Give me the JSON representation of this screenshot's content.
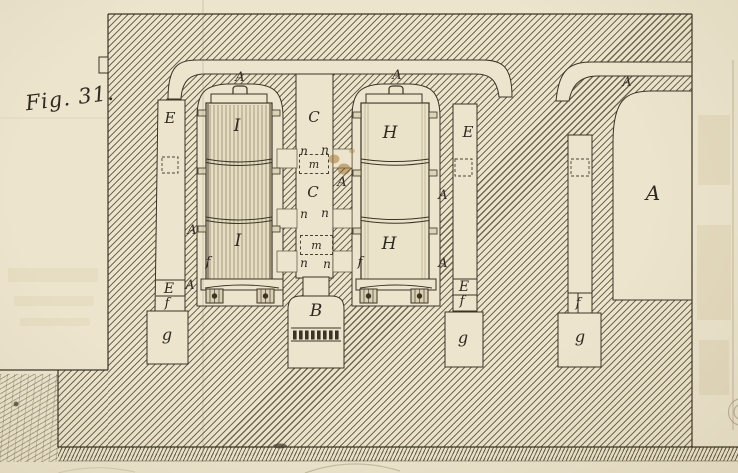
{
  "figure": {
    "title": "Fig. 31.",
    "type": "engraved cross-section of a furnace with two cylinders"
  },
  "palette": {
    "paper": "#ece4cd",
    "ink": "#3b3425",
    "hatch": "#685e47",
    "stain": "#a2702d"
  },
  "labels": {
    "fig_title": "Fig. 31.",
    "arch_a_left": "A",
    "arch_a_right": "A",
    "arch_a_far": "A",
    "e1_top": "E",
    "e2_top": "E",
    "i_upper": "I",
    "h_upper": "H",
    "c_upper": "C",
    "c_mid": "C",
    "a_far_chamber": "A",
    "a_c_wall": "A",
    "a_i_wall_upper": "A",
    "a_i_wall_lower": "A",
    "a_h_wall_upper": "A",
    "a_h_wall_lower": "A",
    "n_1l": "n",
    "n_1r": "n",
    "n_2l": "n",
    "n_2r": "n",
    "n_3l": "n",
    "n_3r": "n",
    "m_1": "m",
    "m_2": "m",
    "i_lower": "I",
    "h_lower": "H",
    "f_i": "f",
    "f_h": "f",
    "e1_bottom": "E",
    "f_1": "f",
    "g_1": "g",
    "e2_bottom": "E",
    "f_2": "f",
    "g_2": "g",
    "f_3": "f",
    "g_3": "g",
    "b_chamber": "B"
  }
}
